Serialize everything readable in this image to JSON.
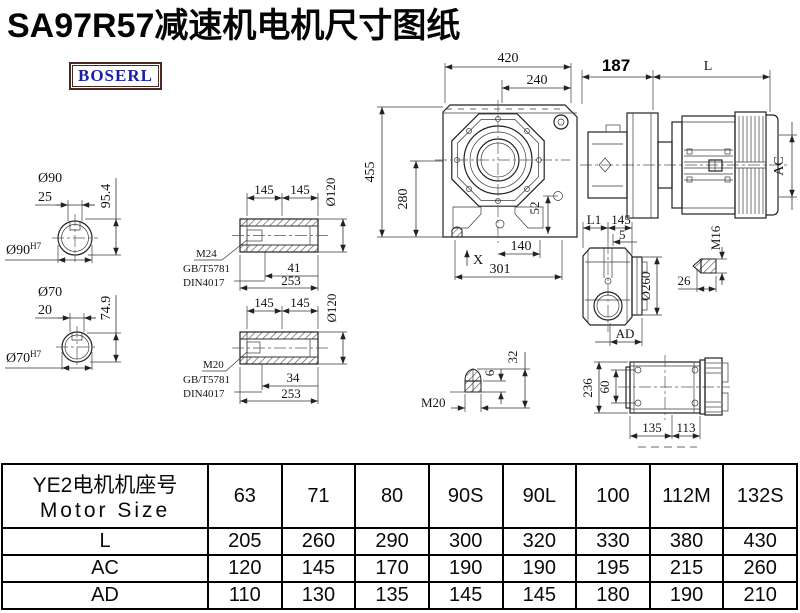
{
  "title": "SA97R57减速机电机尺寸图纸",
  "logo": "BOSERL",
  "dims": {
    "s1_dia": "Ø90",
    "s1_key": "25",
    "s1_h": "95.4",
    "s1_fit": "Ø90",
    "s1_fit_sup": "H7",
    "s2_dia": "Ø70",
    "s2_key": "20",
    "s2_h": "74.9",
    "s2_fit": "Ø70",
    "s2_fit_sup": "H7",
    "hs1_a": "145",
    "hs1_b": "145",
    "hs1_dia": "Ø120",
    "hs1_thread": "M24",
    "hs1_std1": "GB/T5781",
    "hs1_std2": "DIN4017",
    "hs1_depth": "41",
    "hs1_len": "253",
    "hs2_a": "145",
    "hs2_b": "145",
    "hs2_dia": "Ø120",
    "hs2_thread": "M20",
    "hs2_std1": "GB/T5781",
    "hs2_std2": "DIN4017",
    "hs2_depth": "34",
    "hs2_len": "253",
    "gb_420": "420",
    "gb_240": "240",
    "gb_455": "455",
    "gb_280": "280",
    "gb_52": "52",
    "gb_140": "140",
    "gb_301": "301",
    "gb_x": "X",
    "m_187": "187",
    "m_l": "L",
    "m_ac": "AC",
    "fl_l1": "L1",
    "fl_145": "145",
    "fl_5": "5",
    "fl_dia": "Ø260",
    "fl_ad": "AD",
    "fl_m16": "M16",
    "fl_26": "26",
    "bp_m20": "M20",
    "bp_6": "6",
    "bp_32": "32",
    "bv_236": "236",
    "bv_60": "60",
    "bv_135": "135",
    "bv_113": "113"
  },
  "table": {
    "header_cn": "YE2电机机座号",
    "header_en": "Motor Size",
    "sizes": [
      "63",
      "71",
      "80",
      "90S",
      "90L",
      "100",
      "112M",
      "132S"
    ],
    "rows": [
      {
        "label": "L",
        "values": [
          "205",
          "260",
          "290",
          "300",
          "320",
          "330",
          "380",
          "430"
        ]
      },
      {
        "label": "AC",
        "values": [
          "120",
          "145",
          "170",
          "190",
          "190",
          "195",
          "215",
          "260"
        ]
      },
      {
        "label": "AD",
        "values": [
          "110",
          "130",
          "135",
          "145",
          "145",
          "180",
          "190",
          "210"
        ]
      }
    ]
  }
}
